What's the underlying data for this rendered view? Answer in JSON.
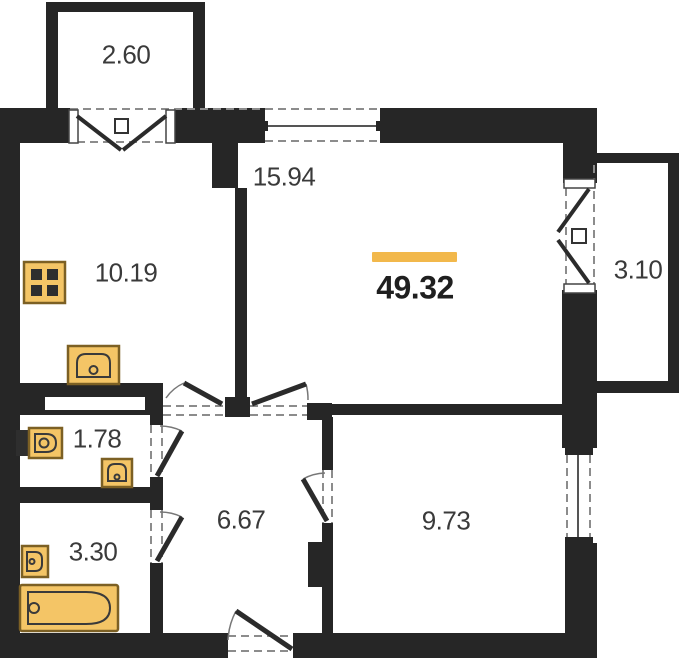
{
  "title": "apartment-floor-plan",
  "total": {
    "area": "49.32"
  },
  "rooms": [
    {
      "id": "balcony-top",
      "area": "2.60"
    },
    {
      "id": "kitchen",
      "area": "10.19"
    },
    {
      "id": "living-room",
      "area": "15.94"
    },
    {
      "id": "balcony-right",
      "area": "3.10"
    },
    {
      "id": "bathroom-small",
      "area": "1.78"
    },
    {
      "id": "hallway",
      "area": "6.67"
    },
    {
      "id": "bathroom",
      "area": "3.30"
    },
    {
      "id": "bedroom",
      "area": "9.73"
    }
  ],
  "fixtures": [
    "stove",
    "kitchen-sink",
    "toilet",
    "washbasin-small",
    "washbasin-bath",
    "bathtub"
  ],
  "colors": {
    "wall": "#262626",
    "fixture": "#F4C566",
    "fixture_border": "#7c6024",
    "accent_bar": "#F2B84B",
    "dash": "#8c8c8c",
    "text": "#3a3a3a",
    "total_text": "#1f1f1f",
    "background": "#ffffff"
  }
}
